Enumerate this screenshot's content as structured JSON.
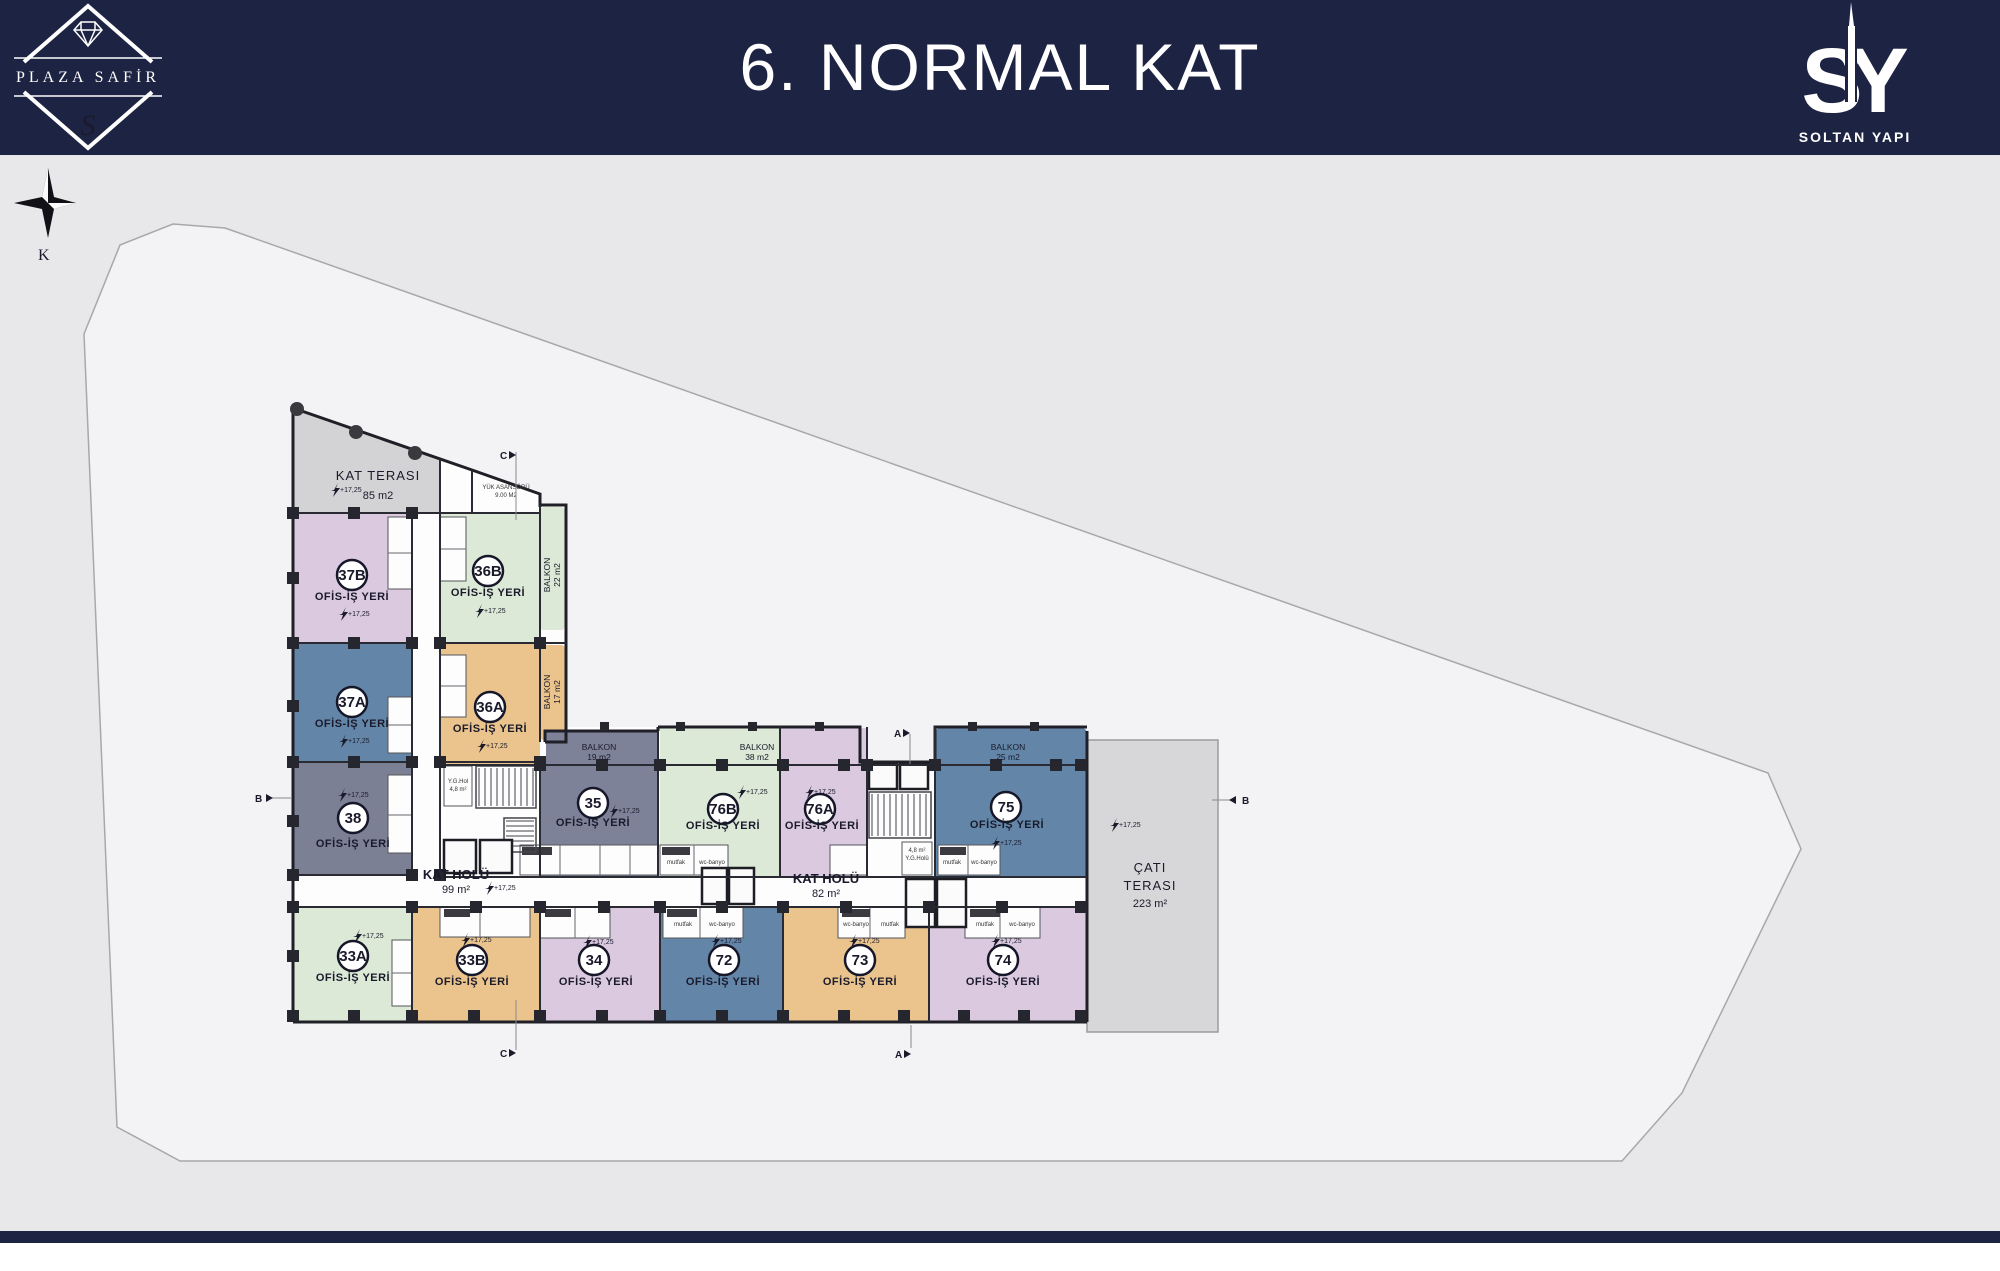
{
  "header": {
    "title": "6. NORMAL KAT",
    "brand_left": {
      "name": "PLAZA SAFİR",
      "monogram": "S"
    },
    "brand_right": {
      "mono_s": "S",
      "mono_y": "Y",
      "name": "SOLTAN YAPI"
    }
  },
  "compass": {
    "label": "K"
  },
  "floor_plan": {
    "elevation_label": "+17,25",
    "terraces": [
      {
        "name": "KAT TERASI",
        "area": "85 m2"
      },
      {
        "name": "ÇATI",
        "name2": "TERASI",
        "area": "223 m²"
      }
    ],
    "halls": [
      {
        "name": "KAT HOLÜ",
        "area": "99 m²"
      },
      {
        "name": "KAT HOLÜ",
        "area": "82 m²"
      }
    ],
    "balconies": [
      {
        "label": "BALKON",
        "area": "22 m2"
      },
      {
        "label": "BALKON",
        "area": "17 m2"
      },
      {
        "label": "BALKON",
        "area": "19 m2"
      },
      {
        "label": "BALKON",
        "area": "38 m2"
      },
      {
        "label": "BALKON",
        "area": "25 m2"
      }
    ],
    "units": [
      {
        "no": "37B",
        "type": "OFİS-İŞ YERİ",
        "color": "#dbc9e0"
      },
      {
        "no": "37A",
        "type": "OFİS-İŞ YERİ",
        "color": "#6386a8"
      },
      {
        "no": "38",
        "type": "OFİS-İŞ YERİ",
        "color": "#7b8095"
      },
      {
        "no": "33A",
        "type": "OFİS-İŞ YERİ",
        "color": "#dbe9d6"
      },
      {
        "no": "36B",
        "type": "OFİS-İŞ YERİ",
        "color": "#dbe9d6"
      },
      {
        "no": "36A",
        "type": "OFİS-İŞ YERİ",
        "color": "#eac48c"
      },
      {
        "no": "35",
        "type": "OFİS-İŞ YERİ",
        "color": "#7d8298"
      },
      {
        "no": "76B",
        "type": "OFİS-İŞ YERİ",
        "color": "#dbe9d6"
      },
      {
        "no": "76A",
        "type": "OFİS-İŞ YERİ",
        "color": "#dbc9e0"
      },
      {
        "no": "75",
        "type": "OFİS-İŞ YERİ",
        "color": "#6386a8"
      },
      {
        "no": "33B",
        "type": "OFİS-İŞ YERİ",
        "color": "#eac48c"
      },
      {
        "no": "34",
        "type": "OFİS-İŞ YERİ",
        "color": "#dbc9e0"
      },
      {
        "no": "72",
        "type": "OFİS-İŞ YERİ",
        "color": "#6386a8"
      },
      {
        "no": "73",
        "type": "OFİS-İŞ YERİ",
        "color": "#eac48c"
      },
      {
        "no": "74",
        "type": "OFİS-İŞ YERİ",
        "color": "#dbc9e0"
      }
    ],
    "service": {
      "freight_elevator": "YÜK ASANSÖRÜ",
      "freight_area": "9.00 M2",
      "yg_hall": "Y.G.Hol",
      "yg_area": "4,8 m²",
      "yg_hall2": "Y.G.Holü",
      "kitchen": "mutfak",
      "bath": "wc-banyo"
    },
    "markers": {
      "a": "A",
      "b": "B",
      "c": "C"
    }
  },
  "colors": {
    "navy": "#1d2342",
    "plot": "#f3f3f5",
    "terrace": "#d3d3d5",
    "outer_bg": "#e8e8ea"
  }
}
